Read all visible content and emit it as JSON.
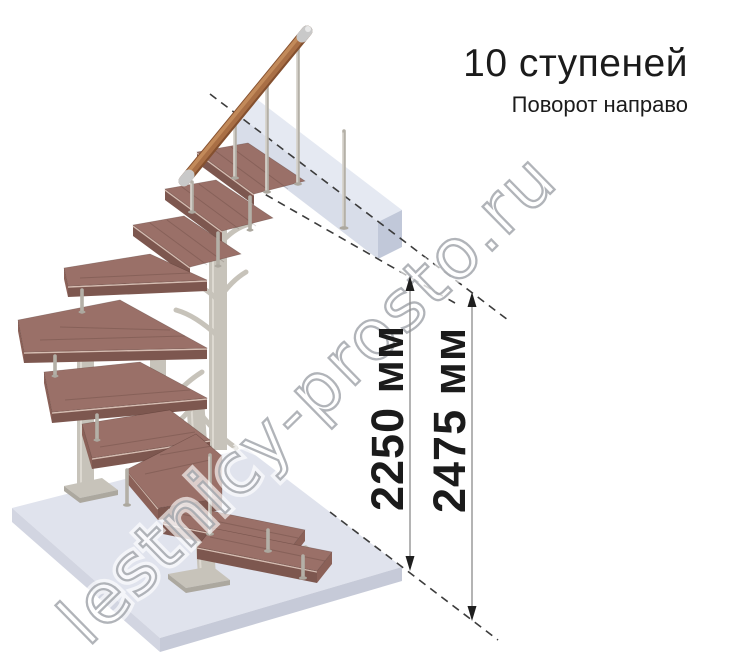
{
  "header": {
    "title": "10 ступеней",
    "subtitle": "Поворот направо"
  },
  "dimensions": {
    "inner": "2250 мм",
    "outer": "2475 мм"
  },
  "watermark": "lestnicy-prosto.ru",
  "illustration": {
    "steps_count": 10,
    "turn_direction": "right",
    "colors": {
      "wood_top": "#9a7068",
      "wood_front": "#7d574f",
      "wood_side": "#8b6158",
      "wood_nose": "#d6bdb2",
      "handrail": "#a96f45",
      "handrail_dark": "#84502f",
      "handrail_light": "#c28a5a",
      "steel": "#c7c3ba",
      "steel_dark": "#aca89f",
      "steel_light": "#e3e0d9",
      "rod": "#b4b0a7",
      "floor_top": "#e0e3ed",
      "floor_left": "#d2d5e1",
      "floor_front": "#c6cad8",
      "beam_top": "#e3e7f1",
      "beam_front": "#d4d9e7",
      "beam_end": "#bcc3d6",
      "dash": "#3c3c3c",
      "dim_line": "#8c8c8c",
      "text": "#1b1b1b",
      "wm_stroke": "#a3a7ad"
    }
  }
}
